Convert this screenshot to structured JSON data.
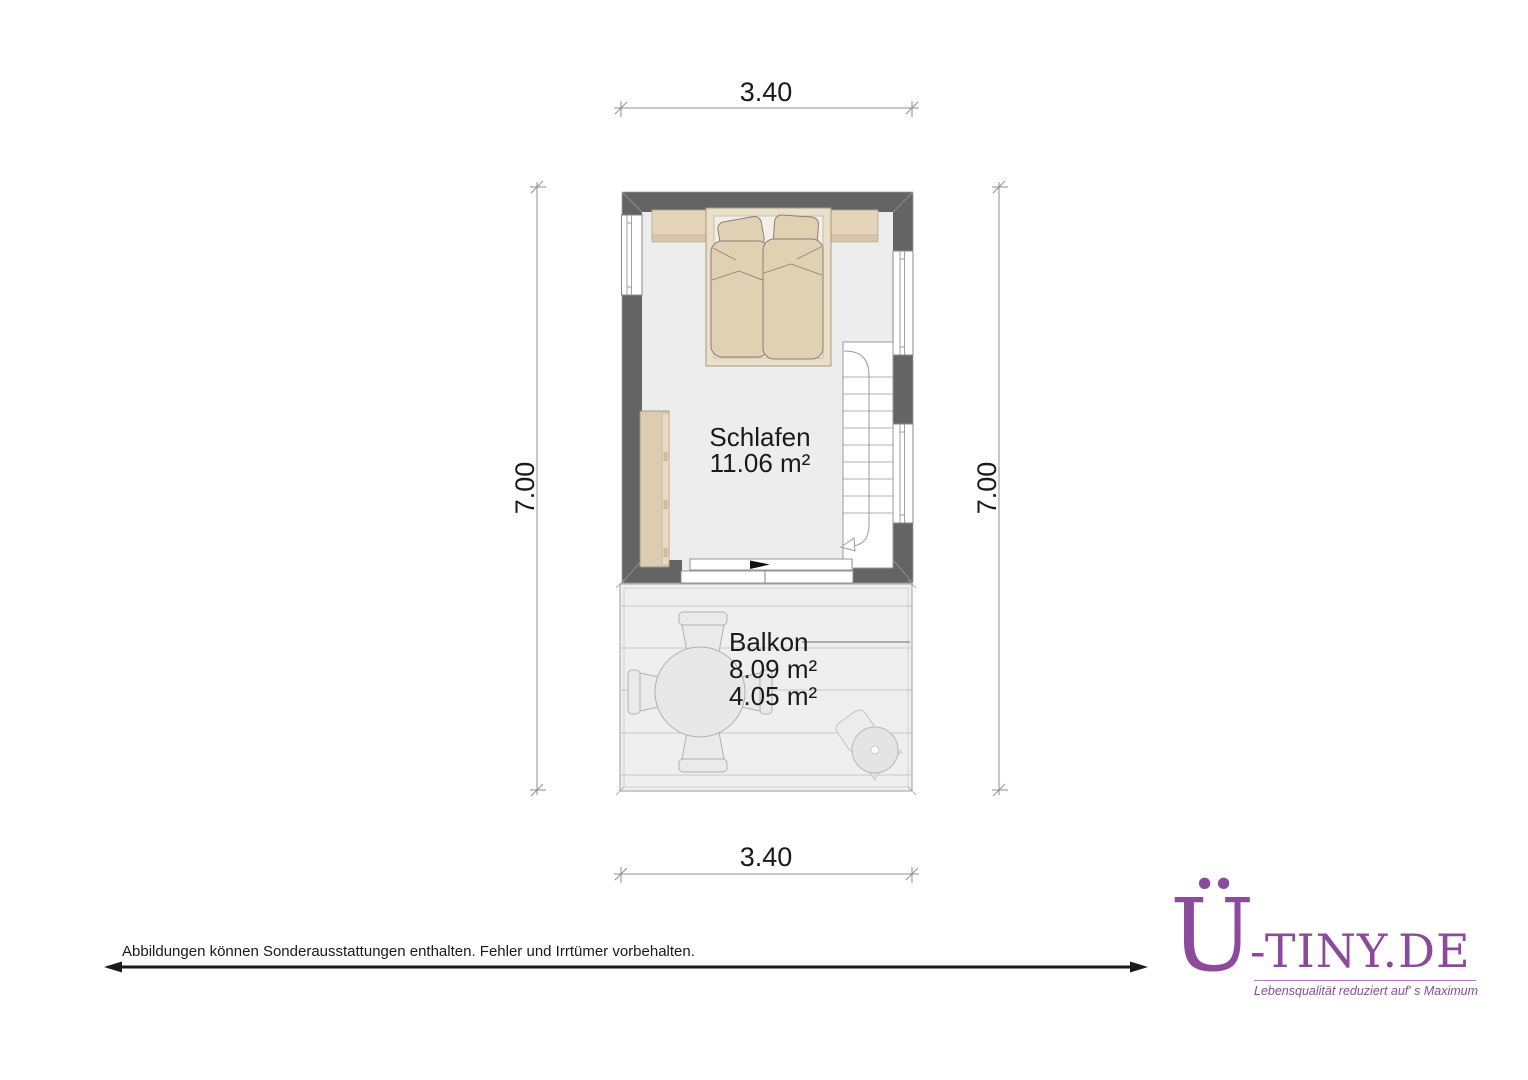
{
  "plan": {
    "room": {
      "name": "Schlafen",
      "area": "11.06 m²"
    },
    "balcony": {
      "name": "Balkon",
      "area_total": "8.09 m²",
      "area_partial": "4.05 m²"
    },
    "dimensions": {
      "width_top": "3.40",
      "width_bottom": "3.40",
      "height_left": "7.00",
      "height_right": "7.00"
    },
    "furniture": [
      "double-bed",
      "headboard-shelf",
      "wardrobe",
      "staircase",
      "sliding-door",
      "balcony-table",
      "chairs",
      "grill-stool"
    ],
    "colors": {
      "wall": "#646464",
      "room_floor": "#ededed",
      "balcony_floor": "#efefef",
      "furniture_beige": "#e1d1b3",
      "furniture_outline": "#8a8174"
    }
  },
  "footer": {
    "disclaimer": "Abbildungen können Sonderausstattungen enthalten. Fehler und Irrtümer vorbehalten."
  },
  "logo": {
    "initial": "Ü",
    "rest": "-TINY.DE",
    "tagline": "Lebensqualität reduziert auf' s Maximum",
    "color": "#8c4a9c"
  }
}
